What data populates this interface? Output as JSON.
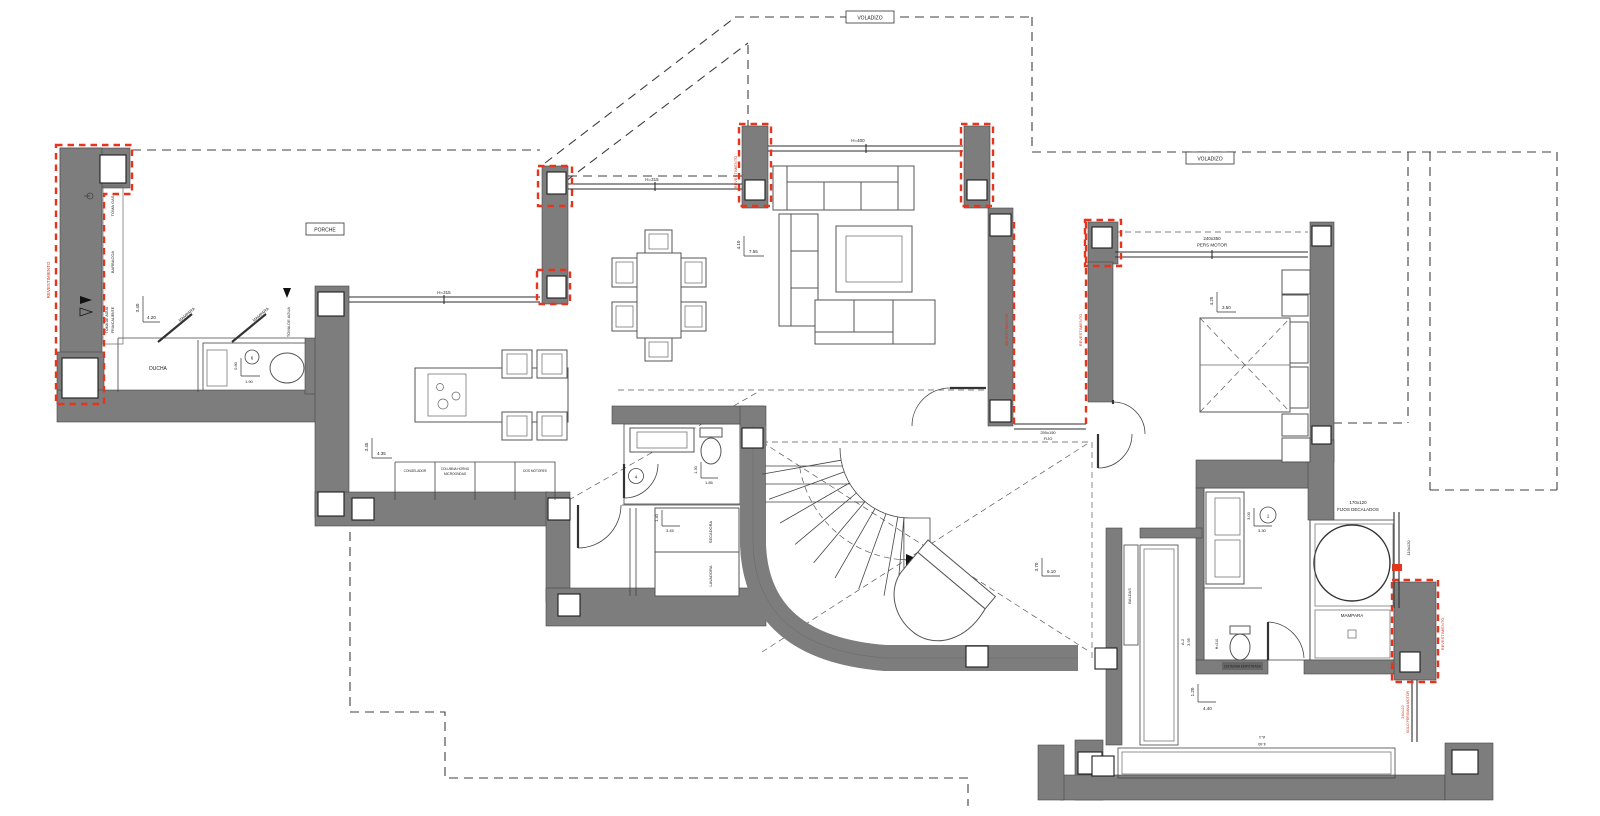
{
  "drawing": {
    "kind": "architectural floor plan",
    "colors": {
      "wall": "#7d7d7d",
      "accent_red": "#e8341c",
      "line": "#333333",
      "hatch": "#b5b5b5"
    }
  },
  "boxed": {
    "voladizo_top": "VOLADIZO",
    "voladizo_right": "VOLADIZO",
    "porche": "PORCHE"
  },
  "labels": {
    "revestimiento": "REVESTIMIENTO",
    "toma_gas": "TOMA GAS",
    "barbacoa": "BARBACOA",
    "toma_agua_l1": "TOMA DE AGUA",
    "toma_agua_l2": "FRIA/CALIENTE",
    "toma_de_agua": "TOMA DE AGUA",
    "ducha": "DUCHA",
    "mampara": "MAMPARA",
    "secadora": "SECADORA",
    "lavadora": "LAVADORA",
    "baldas": "BALDAS",
    "cisterna": "CISTERNA EMPOTRADA",
    "h210": "H=210"
  },
  "windows": {
    "h315": "H=315",
    "h400": "H=400",
    "pers_motor_size": "240x350",
    "pers_motor": "PERS MOTOR",
    "fijo_size": "250x150",
    "fijo": "FIJO",
    "fijos_dec_size": "170x120",
    "fijos_dec": "FIJOS DECALADOS",
    "s110x120": "110x120",
    "solo_pers_size": "240x110",
    "solo_pers": "SOLO PERSIANA MOTOR"
  },
  "cabinets": {
    "c1": "CONGELADOR",
    "c2a": "COLUMNA HORNO",
    "c2b": "MICROONDAS",
    "c3": "DOS MOTORES"
  },
  "dims": {
    "terrace_v": "3.40",
    "terrace_h": "4.20",
    "outbath_v": "0.80",
    "outbath_h": "1.90",
    "kitchen_v": "3.45",
    "kitchen_h": "4.35",
    "living_v": "4.10",
    "living_h": "7.55",
    "wc_v": "1.30",
    "wc_h": "1.85",
    "laundry_v": "1.40",
    "laundry_h": "3.45",
    "hall_v": "3.70",
    "hall_h": "6.10",
    "bedroom_v": "4.25",
    "bedroom_h": "3.50",
    "bath_v": "3.00",
    "bath_h": "3.30",
    "dressing_v": "1.20",
    "dressing_h": "4.40",
    "a1_label": "A-1",
    "a1_len": "4.40",
    "a2_label": "A-2",
    "a2_len": "3.95"
  },
  "markers": {
    "m1": "1",
    "m4": "4",
    "m6": "6"
  }
}
